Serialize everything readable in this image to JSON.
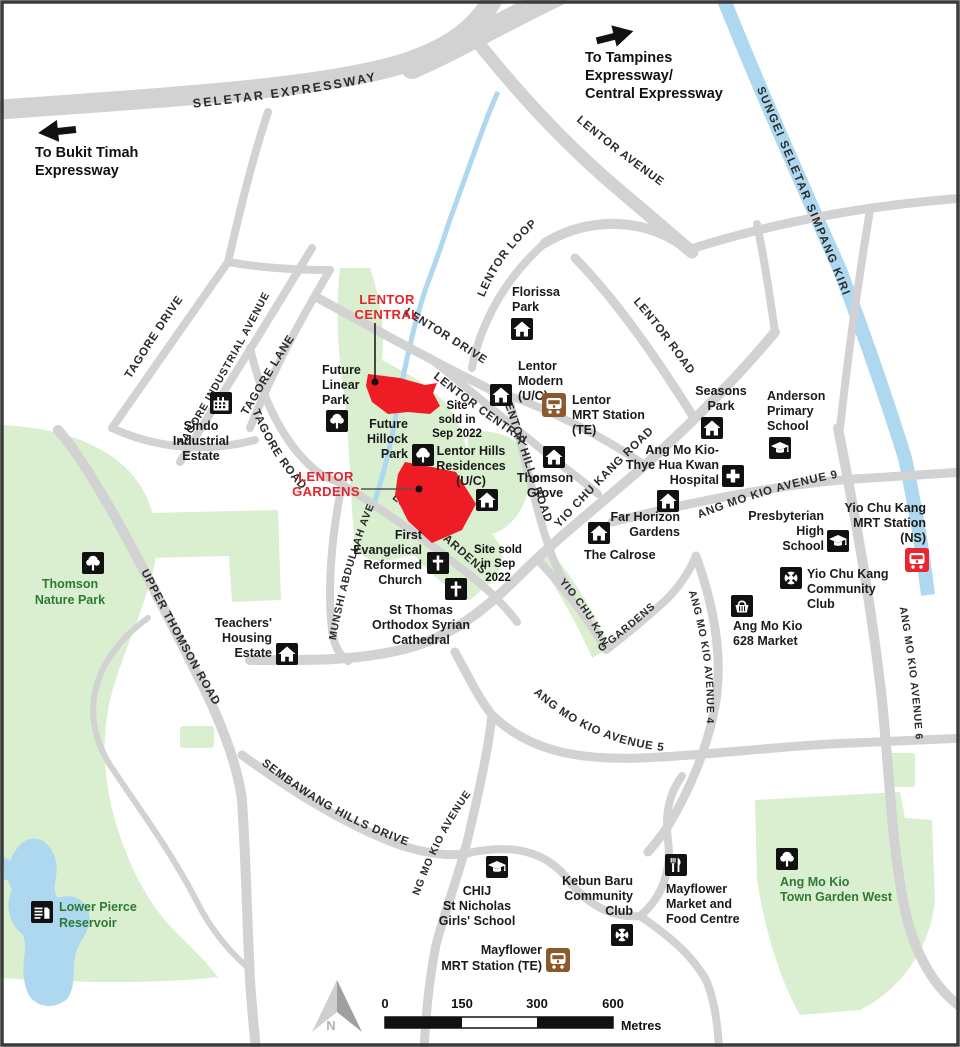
{
  "colors": {
    "road": "#d2d2d3",
    "park_fill": "#d9efcf",
    "water_fill": "#aed7f0",
    "site_red": "#ee1c24",
    "site_label_red": "#e4242b",
    "mrt_te_brown": "#8a5a2d",
    "mrt_ns_red": "#e8262d",
    "park_label_green": "#2e7a34"
  },
  "offmap": {
    "left_arrow": {
      "lines": [
        "To Bukit Timah",
        "Expressway"
      ]
    },
    "right_arrow": {
      "lines": [
        "To Tampines",
        "Expressway/",
        "Central Expressway"
      ]
    }
  },
  "water": {
    "river_label": "SUNGEI SELETAR SIMPANG KIRI"
  },
  "roads": {
    "seletar_expressway": "SELETAR EXPRESSWAY",
    "lentor_avenue": "LENTOR AVENUE",
    "lentor_loop": "LENTOR LOOP",
    "lentor_drive": "LENTOR DRIVE",
    "lentor_road": "LENTOR ROAD",
    "lentor_central": "LENTOR CENTRAL",
    "lentor_hills_road": "LENTOR HILLS ROAD",
    "lentor_gardens": "LENTOR GARDENS",
    "tagore_drive": "TAGORE DRIVE",
    "tagore_industrial_avenue": "TAGORE INDUSTRIAL AVENUE",
    "tagore_lane": "TAGORE LANE",
    "tagore_road": "TAGORE ROAD",
    "upper_thomson_road": "UPPER THOMSON ROAD",
    "munshi_abdullah_ave": "MUNSHI ABDULLAH AVE",
    "yio_chu_kang_road": "YIO CHU KANG ROAD",
    "yio_chu_kang_gardens": "YIO CHU KANG GARDENS",
    "ang_mo_kio_avenue_9": "ANG MO KIO AVENUE 9",
    "ang_mo_kio_avenue_4": "ANG MO KIO AVENUE 4",
    "ang_mo_kio_avenue_5": "ANG MO KIO AVENUE 5",
    "ang_mo_kio_avenue_2": "ANG MO KIO AVENUE 2",
    "ang_mo_kio_avenue_6": "ANG MO KIO AVENUE 6",
    "sembawang_hills_drive": "SEMBAWANG HILLS DRIVE"
  },
  "sites": {
    "lentor_central": {
      "label_lines": [
        "LENTOR",
        "CENTRAL"
      ]
    },
    "lentor_gardens": {
      "label_lines": [
        "LENTOR",
        "GARDENS"
      ]
    },
    "note_1_lines": [
      "Site",
      "sold in",
      "Sep 2022"
    ],
    "note_2_lines": [
      "Site sold",
      "in Sep",
      "2022"
    ]
  },
  "pois": {
    "florissa_park": {
      "icon": "housing-icon",
      "lines": [
        "Florissa",
        "Park"
      ]
    },
    "future_linear_park": {
      "icon": "tree-icon",
      "lines": [
        "Future",
        "Linear",
        "Park"
      ]
    },
    "future_hillock_park": {
      "icon": "tree-icon",
      "lines": [
        "Future",
        "Hillock",
        "Park"
      ]
    },
    "sindo_industrial_estate": {
      "icon": "factory-icon",
      "lines": [
        "Sindo",
        "Industrial",
        "Estate"
      ]
    },
    "lentor_modern": {
      "icon": "housing-icon",
      "lines": [
        "Lentor",
        "Modern",
        "(U/C)"
      ]
    },
    "lentor_mrt_station": {
      "icon": "mrt-te-icon",
      "lines": [
        "Lentor",
        "MRT Station",
        "(TE)"
      ]
    },
    "lentor_hills_residences": {
      "icon": "housing-icon",
      "lines": [
        "Lentor Hills",
        "Residences",
        "(U/C)"
      ]
    },
    "thomson_grove": {
      "icon": "housing-icon",
      "lines": [
        "Thomson",
        "Grove"
      ]
    },
    "seasons_park": {
      "icon": "housing-icon",
      "lines": [
        "Seasons",
        "Park"
      ]
    },
    "anderson_primary_school": {
      "icon": "school-icon",
      "lines": [
        "Anderson",
        "Primary",
        "School"
      ]
    },
    "amk_thye_hua_kwan_hospital": {
      "icon": "hospital-icon",
      "lines": [
        "Ang Mo Kio-",
        "Thye Hua Kwan",
        "Hospital"
      ]
    },
    "far_horizon_gardens": {
      "icon": "housing-icon",
      "lines": [
        "Far Horizon",
        "Gardens"
      ]
    },
    "the_calrose": {
      "icon": "housing-icon",
      "lines": [
        "The Calrose"
      ]
    },
    "presbyterian_high_school": {
      "icon": "school-icon",
      "lines": [
        "Presbyterian",
        "High",
        "School"
      ]
    },
    "yio_chu_kang_mrt_station": {
      "icon": "mrt-ns-icon",
      "lines": [
        "Yio Chu Kang",
        "MRT Station",
        "(NS)"
      ]
    },
    "yio_chu_kang_community_club": {
      "icon": "community-club-icon",
      "lines": [
        "Yio Chu Kang",
        "Community",
        "Club"
      ]
    },
    "ang_mo_kio_628_market": {
      "icon": "market-icon",
      "lines": [
        "Ang Mo Kio",
        "628 Market"
      ]
    },
    "thomson_nature_park": {
      "icon": "tree-icon",
      "lines": [
        "Thomson",
        "Nature Park"
      ]
    },
    "teachers_housing_estate": {
      "icon": "housing-icon",
      "lines": [
        "Teachers'",
        "Housing",
        "Estate"
      ]
    },
    "first_evangelical_reformed_church": {
      "icon": "church-icon",
      "lines": [
        "First",
        "Evangelical",
        "Reformed",
        "Church"
      ]
    },
    "st_thomas_cathedral": {
      "icon": "church-icon",
      "lines": [
        "St Thomas",
        "Orthodox Syrian",
        "Cathedral"
      ]
    },
    "lower_pierce_reservoir": {
      "icon": "reservoir-icon",
      "lines": [
        "Lower Pierce",
        "Reservoir"
      ]
    },
    "chij_st_nicholas": {
      "icon": "school-icon",
      "lines": [
        "CHIJ",
        "St Nicholas",
        "Girls' School"
      ]
    },
    "kebun_baru_community_club": {
      "icon": "community-club-icon",
      "lines": [
        "Kebun Baru",
        "Community",
        "Club"
      ]
    },
    "mayflower_market_food_centre": {
      "icon": "food-icon",
      "lines": [
        "Mayflower",
        "Market and",
        "Food Centre"
      ]
    },
    "amk_town_garden_west": {
      "icon": "tree-icon",
      "lines": [
        "Ang Mo Kio",
        "Town Garden West"
      ]
    },
    "mayflower_mrt_station": {
      "icon": "mrt-te-icon",
      "lines": [
        "Mayflower",
        "MRT Station (TE)"
      ]
    }
  },
  "legend": {
    "north_label": "N",
    "scale_ticks": [
      "0",
      "150",
      "300",
      "600"
    ],
    "scale_unit": "Metres"
  }
}
